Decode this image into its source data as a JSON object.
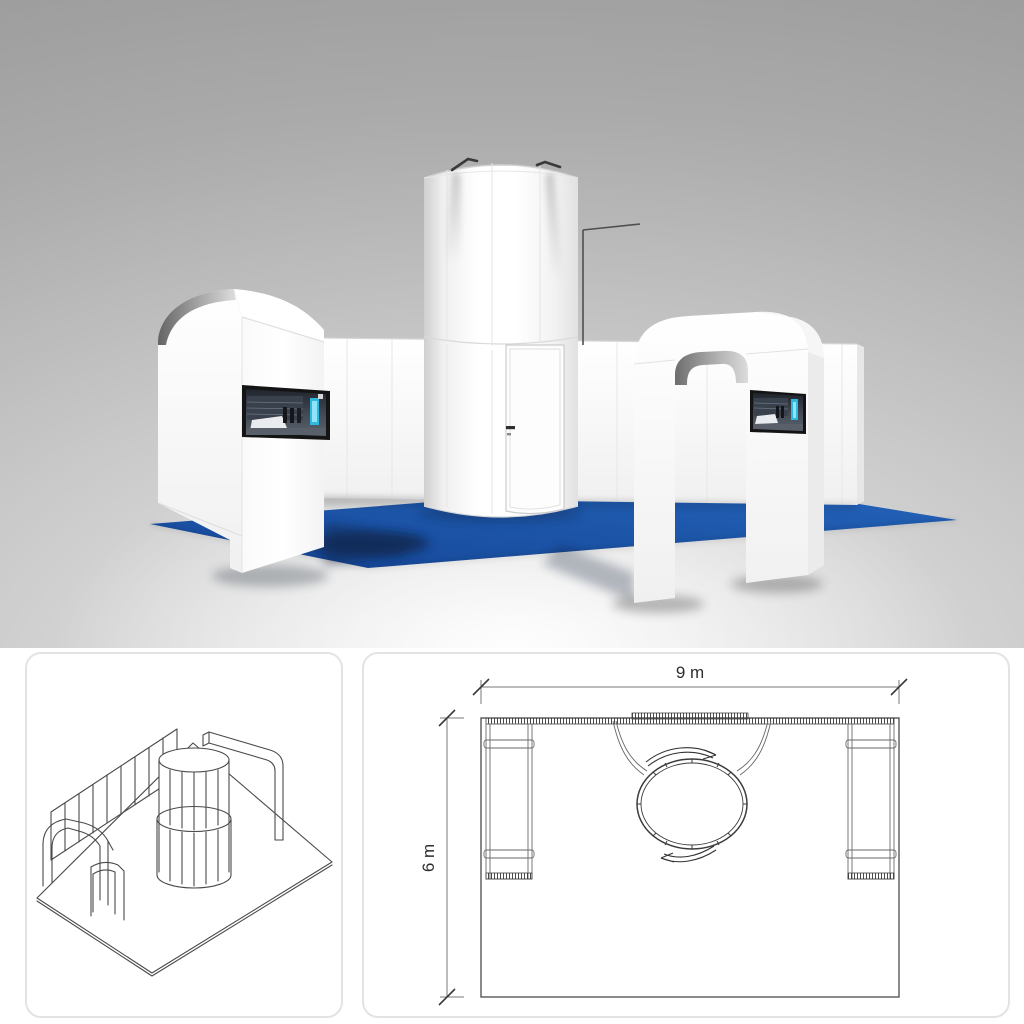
{
  "render": {
    "subject": "exhibition-stand-3d-render",
    "carpet_color": "#1d56a9",
    "structure_color": "#ffffff",
    "left_screen": "wall-mounted-display",
    "right_screen": "wall-mounted-display"
  },
  "isometric": {
    "subject": "frame-structure-wireframe"
  },
  "floorplan": {
    "width_label": "9 m",
    "depth_label": "6 m"
  }
}
